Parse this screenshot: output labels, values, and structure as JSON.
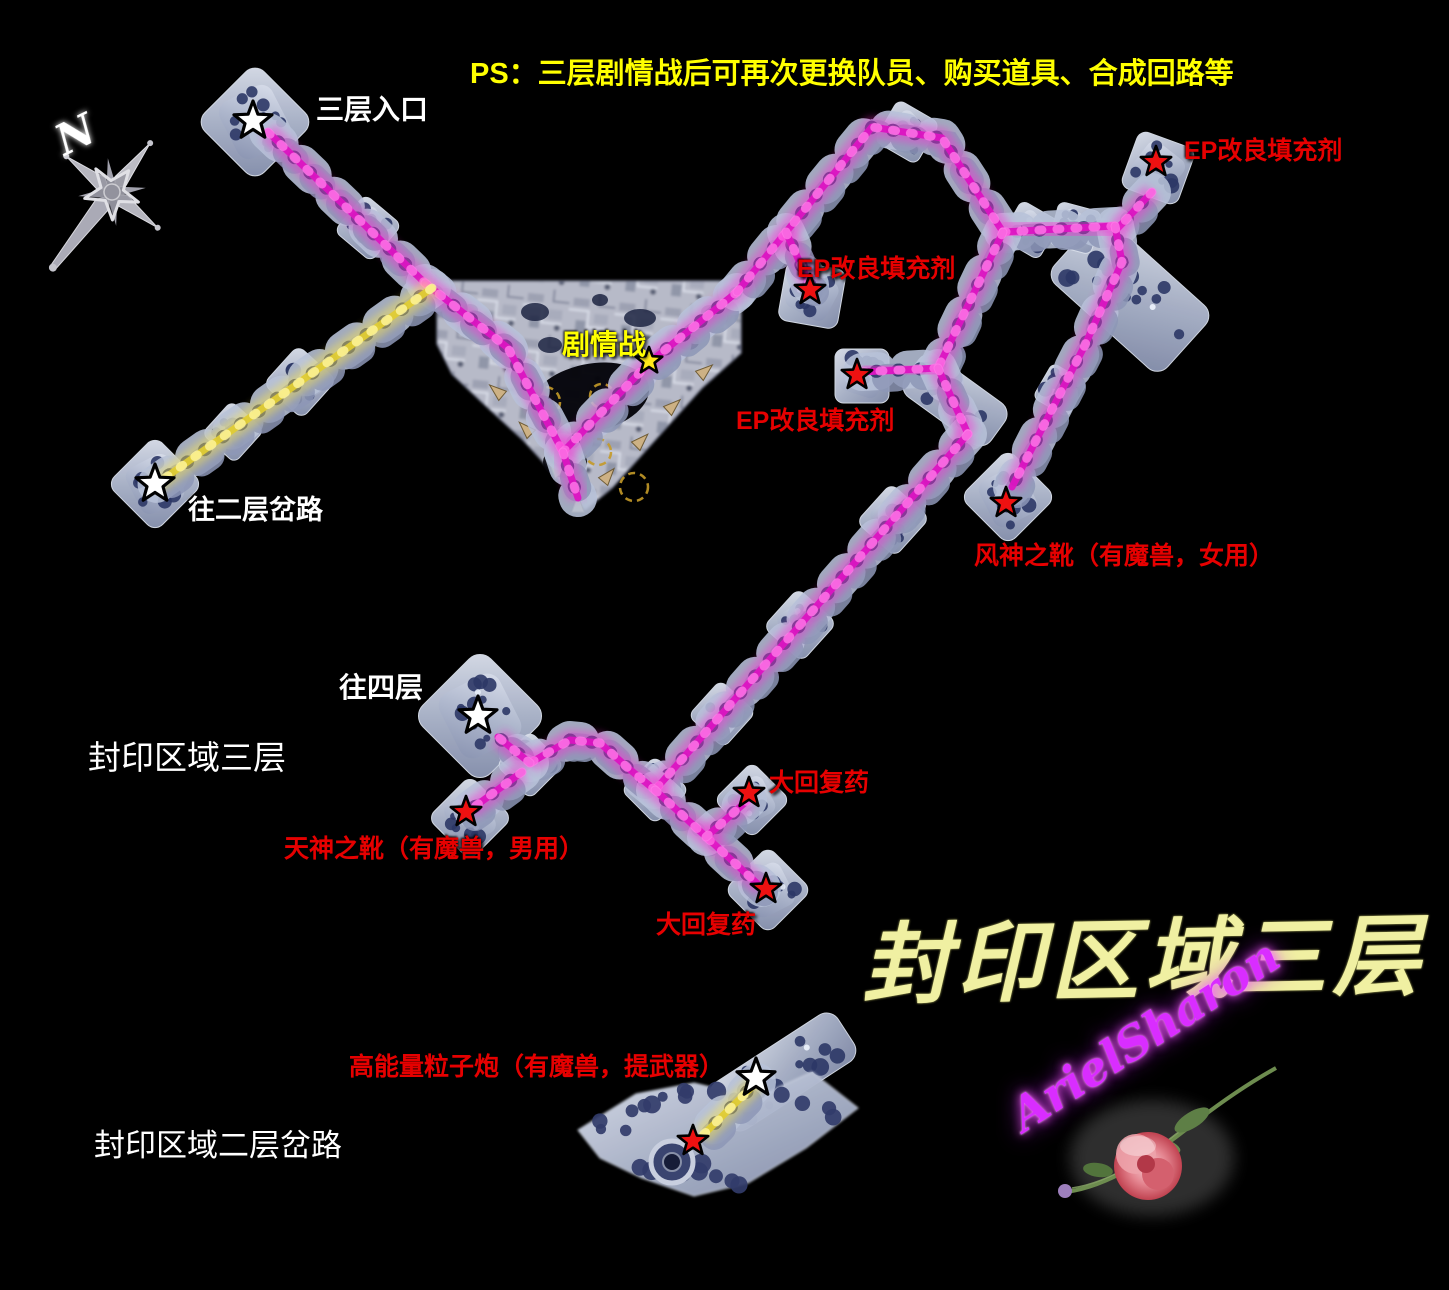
{
  "note_ps": "PS：三层剧情战后可再次更换队员、购买道具、合成回路等",
  "labels": {
    "compass_n": "N",
    "entrance": "三层入口",
    "to_floor2_fork": "往二层岔路",
    "story_battle": "剧情战",
    "ep_item_top": "EP改良填充剂",
    "ep_item_mid": "EP改良填充剂",
    "ep_item_low": "EP改良填充剂",
    "wind_boots": "风神之靴（有魔兽，女用）",
    "to_floor4": "往四层",
    "area_name_small": "封印区域三层",
    "sky_boots": "天神之靴（有魔兽，男用）",
    "potion_upper": "大回复药",
    "potion_lower": "大回复药",
    "area_name_big": "封印区域三层",
    "particle_cannon": "高能量粒子炮（有魔兽，提武器）",
    "floor2_fork_area": "封印区域二层岔路",
    "signature": "ArielSharon"
  },
  "colors": {
    "background": "#000000",
    "path_magenta": "#dc14c2",
    "path_magenta_glow": "#ff2bd6",
    "path_magenta_bead": "#ff7ae8",
    "path_yellow": "#e0cc34",
    "path_yellow_glow": "#ffe84a",
    "path_yellow_bead": "#fff6a0",
    "star_red": "#ee1111",
    "star_white": "#ffffff",
    "star_yellow": "#ffe81a",
    "label_red": "#e60000",
    "label_yellow": "#ffff00",
    "label_white": "#ffffff",
    "calligraphy_yellow": "#f0f0a2",
    "signature_magenta": "#d92dff"
  },
  "map": {
    "region": {
      "polygon": [
        [
          437,
          281
        ],
        [
          741,
          281
        ],
        [
          741,
          353
        ],
        [
          702,
          388
        ],
        [
          648,
          448
        ],
        [
          612,
          488
        ],
        [
          585,
          510
        ],
        [
          558,
          478
        ],
        [
          523,
          440
        ],
        [
          487,
          407
        ],
        [
          452,
          374
        ],
        [
          437,
          344
        ]
      ]
    },
    "paths": [
      {
        "name": "entrance-diagonal",
        "color": "magenta",
        "points": [
          [
            268,
            132
          ],
          [
            425,
            283
          ]
        ]
      },
      {
        "name": "into-region",
        "color": "magenta",
        "points": [
          [
            425,
            283
          ],
          [
            508,
            348
          ],
          [
            563,
            452
          ]
        ]
      },
      {
        "name": "region-v-right",
        "color": "magenta",
        "points": [
          [
            563,
            452
          ],
          [
            650,
            362
          ],
          [
            737,
            292
          ]
        ]
      },
      {
        "name": "region-spur",
        "color": "magenta",
        "points": [
          [
            563,
            452
          ],
          [
            578,
            498
          ]
        ]
      },
      {
        "name": "peak-ridge",
        "color": "magenta",
        "points": [
          [
            737,
            292
          ],
          [
            872,
            127
          ],
          [
            942,
            138
          ],
          [
            1003,
            232
          ]
        ]
      },
      {
        "name": "ridge-bar",
        "color": "magenta",
        "points": [
          [
            1003,
            232
          ],
          [
            1115,
            226
          ]
        ]
      },
      {
        "name": "ep-mid-stub",
        "color": "magenta",
        "points": [
          [
            786,
            232
          ],
          [
            810,
            285
          ]
        ]
      },
      {
        "name": "ep-top-stub",
        "color": "magenta",
        "points": [
          [
            1152,
            192
          ],
          [
            1118,
            228
          ]
        ]
      },
      {
        "name": "slab-descent",
        "color": "magenta",
        "points": [
          [
            1115,
            226
          ],
          [
            1122,
            262
          ],
          [
            1085,
            345
          ],
          [
            1012,
            487
          ]
        ]
      },
      {
        "name": "mid-connector",
        "color": "magenta",
        "points": [
          [
            1003,
            232
          ],
          [
            938,
            368
          ]
        ]
      },
      {
        "name": "ep-low-stub",
        "color": "magenta",
        "points": [
          [
            862,
            372
          ],
          [
            938,
            368
          ]
        ]
      },
      {
        "name": "band-down",
        "color": "magenta",
        "points": [
          [
            938,
            368
          ],
          [
            968,
            434
          ]
        ]
      },
      {
        "name": "long-diagonal",
        "color": "magenta",
        "points": [
          [
            968,
            434
          ],
          [
            655,
            790
          ]
        ]
      },
      {
        "name": "curve-to-junction",
        "color": "magenta",
        "points": [
          [
            655,
            790
          ],
          [
            628,
            768
          ],
          [
            600,
            743
          ],
          [
            570,
            740
          ],
          [
            530,
            763
          ]
        ]
      },
      {
        "name": "link-to-floor4",
        "color": "magenta",
        "points": [
          [
            530,
            763
          ],
          [
            498,
            737
          ]
        ]
      },
      {
        "name": "link-to-sky-boots",
        "color": "magenta",
        "points": [
          [
            522,
            772
          ],
          [
            470,
            810
          ]
        ]
      },
      {
        "name": "down-to-potion",
        "color": "magenta",
        "points": [
          [
            655,
            790
          ],
          [
            762,
            888
          ]
        ]
      },
      {
        "name": "potion-stub",
        "color": "magenta",
        "points": [
          [
            706,
            837
          ],
          [
            748,
            800
          ]
        ]
      },
      {
        "name": "yellow-to-floor2",
        "color": "yellow",
        "points": [
          [
            432,
            288
          ],
          [
            155,
            485
          ]
        ]
      },
      {
        "name": "yellow-bottom",
        "color": "yellow",
        "points": [
          [
            757,
            1082
          ],
          [
            702,
            1136
          ]
        ]
      }
    ],
    "islands": [
      {
        "x": 255,
        "y": 122,
        "r": 42,
        "rot": 45
      },
      {
        "x": 368,
        "y": 228,
        "r": 24,
        "rot": 40
      },
      {
        "x": 155,
        "y": 484,
        "r": 34,
        "rot": 45
      },
      {
        "x": 300,
        "y": 382,
        "r": 26,
        "rot": 42
      },
      {
        "x": 233,
        "y": 432,
        "r": 22,
        "rot": 42
      },
      {
        "x": 907,
        "y": 132,
        "r": 24,
        "rot": 30
      },
      {
        "x": 1030,
        "y": 230,
        "r": 22,
        "rot": 30
      },
      {
        "x": 1075,
        "y": 228,
        "r": 22,
        "rot": 15
      },
      {
        "x": 812,
        "y": 295,
        "r": 30,
        "rot": 10
      },
      {
        "x": 1158,
        "y": 168,
        "r": 30,
        "rot": 20
      },
      {
        "x": 862,
        "y": 376,
        "r": 27,
        "rot": 0
      },
      {
        "x": 1060,
        "y": 390,
        "r": 20,
        "rot": 30
      },
      {
        "x": 1008,
        "y": 497,
        "r": 34,
        "rot": 45
      },
      {
        "x": 893,
        "y": 520,
        "r": 26,
        "rot": 42
      },
      {
        "x": 800,
        "y": 625,
        "r": 26,
        "rot": 42
      },
      {
        "x": 722,
        "y": 714,
        "r": 24,
        "rot": 42
      },
      {
        "x": 655,
        "y": 790,
        "r": 24,
        "rot": 45
      },
      {
        "x": 480,
        "y": 716,
        "r": 48,
        "rot": 45
      },
      {
        "x": 530,
        "y": 765,
        "r": 24,
        "rot": 45
      },
      {
        "x": 470,
        "y": 818,
        "r": 30,
        "rot": 45
      },
      {
        "x": 752,
        "y": 800,
        "r": 27,
        "rot": 45
      },
      {
        "x": 768,
        "y": 890,
        "r": 31,
        "rot": 45
      }
    ],
    "slabs": [
      {
        "x": 1130,
        "y": 295,
        "w": 152,
        "h": 84,
        "rot": 42
      },
      {
        "x": 955,
        "y": 400,
        "w": 106,
        "h": 50,
        "rot": 36
      },
      {
        "x": 783,
        "y": 1072,
        "w": 150,
        "h": 56,
        "rot": -33
      }
    ],
    "cluster": {
      "polygon": [
        [
          578,
          1130
        ],
        [
          636,
          1094
        ],
        [
          694,
          1083
        ],
        [
          756,
          1098
        ],
        [
          812,
          1072
        ],
        [
          858,
          1108
        ],
        [
          806,
          1148
        ],
        [
          748,
          1183
        ],
        [
          694,
          1196
        ],
        [
          642,
          1178
        ],
        [
          600,
          1158
        ]
      ],
      "ring": {
        "x": 672,
        "y": 1162,
        "r": 21
      }
    },
    "stars": {
      "white": [
        [
          253,
          121
        ],
        [
          155,
          484
        ],
        [
          478,
          716
        ],
        [
          756,
          1078
        ]
      ],
      "red": [
        [
          1156,
          162
        ],
        [
          810,
          290
        ],
        [
          857,
          375
        ],
        [
          1006,
          503
        ],
        [
          466,
          812
        ],
        [
          749,
          793
        ],
        [
          766,
          889
        ],
        [
          693,
          1141
        ]
      ],
      "yellow": [
        [
          649,
          361
        ]
      ]
    }
  }
}
